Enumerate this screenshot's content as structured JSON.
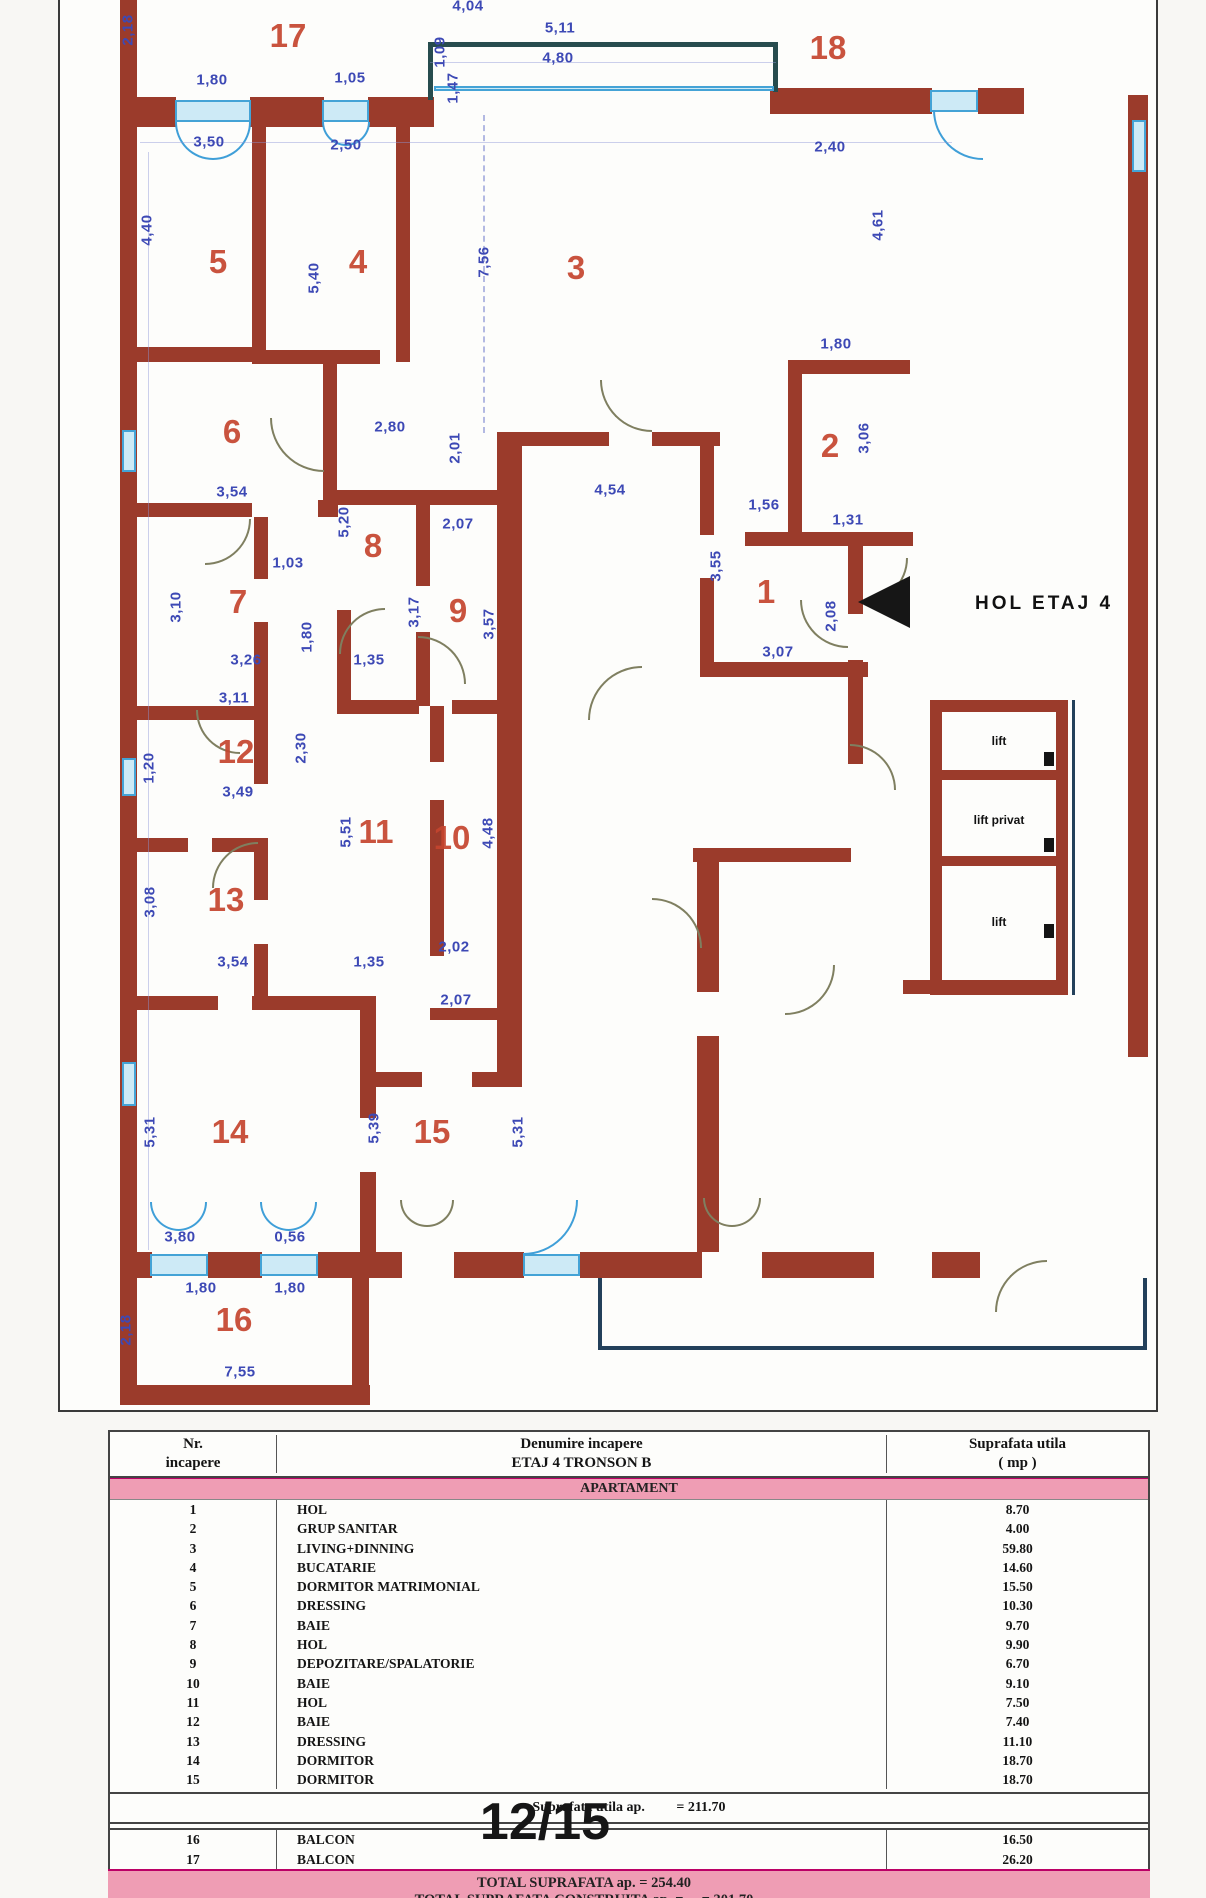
{
  "plan": {
    "hall_label": "HOL ETAJ 4",
    "lift_labels": [
      {
        "t": "lift",
        "x": 999,
        "y": 741
      },
      {
        "t": "lift privat",
        "x": 999,
        "y": 820
      },
      {
        "t": "lift",
        "x": 999,
        "y": 922
      }
    ],
    "rooms": [
      {
        "n": "17",
        "x": 288,
        "y": 36
      },
      {
        "n": "18",
        "x": 828,
        "y": 48
      },
      {
        "n": "5",
        "x": 218,
        "y": 262
      },
      {
        "n": "4",
        "x": 358,
        "y": 262
      },
      {
        "n": "3",
        "x": 576,
        "y": 268
      },
      {
        "n": "6",
        "x": 232,
        "y": 432
      },
      {
        "n": "2",
        "x": 830,
        "y": 446
      },
      {
        "n": "8",
        "x": 373,
        "y": 546
      },
      {
        "n": "7",
        "x": 238,
        "y": 602
      },
      {
        "n": "9",
        "x": 458,
        "y": 611
      },
      {
        "n": "1",
        "x": 766,
        "y": 592
      },
      {
        "n": "12",
        "x": 236,
        "y": 752
      },
      {
        "n": "11",
        "x": 376,
        "y": 832
      },
      {
        "n": "10",
        "x": 452,
        "y": 838
      },
      {
        "n": "13",
        "x": 226,
        "y": 900
      },
      {
        "n": "14",
        "x": 230,
        "y": 1132
      },
      {
        "n": "15",
        "x": 432,
        "y": 1132
      },
      {
        "n": "16",
        "x": 234,
        "y": 1320
      }
    ],
    "dims": [
      {
        "t": "2,18",
        "x": 128,
        "y": 30,
        "v": 1
      },
      {
        "t": "1,80",
        "x": 212,
        "y": 80
      },
      {
        "t": "1,05",
        "x": 350,
        "y": 78
      },
      {
        "t": "1,09",
        "x": 440,
        "y": 52,
        "v": 1
      },
      {
        "t": "1,47",
        "x": 453,
        "y": 88,
        "v": 1
      },
      {
        "t": "5,11",
        "x": 560,
        "y": 28
      },
      {
        "t": "4,80",
        "x": 558,
        "y": 58
      },
      {
        "t": "4,04",
        "x": 468,
        "y": 6
      },
      {
        "t": "2,40",
        "x": 830,
        "y": 147
      },
      {
        "t": "3,50",
        "x": 209,
        "y": 142
      },
      {
        "t": "2,50",
        "x": 346,
        "y": 145
      },
      {
        "t": "4,40",
        "x": 147,
        "y": 230,
        "v": 1
      },
      {
        "t": "5,40",
        "x": 314,
        "y": 278,
        "v": 1
      },
      {
        "t": "7,56",
        "x": 484,
        "y": 262,
        "v": 1
      },
      {
        "t": "4,61",
        "x": 878,
        "y": 225,
        "v": 1
      },
      {
        "t": "1,80",
        "x": 836,
        "y": 344
      },
      {
        "t": "3,06",
        "x": 864,
        "y": 438,
        "v": 1
      },
      {
        "t": "2,80",
        "x": 390,
        "y": 427
      },
      {
        "t": "2,01",
        "x": 455,
        "y": 448,
        "v": 1
      },
      {
        "t": "3,54",
        "x": 232,
        "y": 492
      },
      {
        "t": "4,54",
        "x": 610,
        "y": 490
      },
      {
        "t": "1,56",
        "x": 764,
        "y": 505
      },
      {
        "t": "1,31",
        "x": 848,
        "y": 520
      },
      {
        "t": "5,20",
        "x": 344,
        "y": 522,
        "v": 1
      },
      {
        "t": "2,07",
        "x": 458,
        "y": 524
      },
      {
        "t": "3,17",
        "x": 414,
        "y": 612,
        "v": 1
      },
      {
        "t": "3,57",
        "x": 489,
        "y": 624,
        "v": 1
      },
      {
        "t": "3,55",
        "x": 716,
        "y": 566,
        "v": 1
      },
      {
        "t": "1,03",
        "x": 288,
        "y": 563
      },
      {
        "t": "3,10",
        "x": 176,
        "y": 607,
        "v": 1
      },
      {
        "t": "1,80",
        "x": 307,
        "y": 637,
        "v": 1
      },
      {
        "t": "2,08",
        "x": 831,
        "y": 616,
        "v": 1
      },
      {
        "t": "3,07",
        "x": 778,
        "y": 652
      },
      {
        "t": "3,26",
        "x": 246,
        "y": 660
      },
      {
        "t": "1,35",
        "x": 369,
        "y": 660
      },
      {
        "t": "3,11",
        "x": 234,
        "y": 698
      },
      {
        "t": "2,30",
        "x": 301,
        "y": 748,
        "v": 1
      },
      {
        "t": "1,20",
        "x": 149,
        "y": 768,
        "v": 1
      },
      {
        "t": "3,49",
        "x": 238,
        "y": 792
      },
      {
        "t": "5,51",
        "x": 346,
        "y": 832,
        "v": 1
      },
      {
        "t": "4,48",
        "x": 488,
        "y": 833,
        "v": 1
      },
      {
        "t": "3,08",
        "x": 150,
        "y": 902,
        "v": 1
      },
      {
        "t": "3,54",
        "x": 233,
        "y": 962
      },
      {
        "t": "1,35",
        "x": 369,
        "y": 962
      },
      {
        "t": "2,02",
        "x": 454,
        "y": 947
      },
      {
        "t": "2,07",
        "x": 456,
        "y": 1000
      },
      {
        "t": "5,31",
        "x": 150,
        "y": 1132,
        "v": 1
      },
      {
        "t": "5,39",
        "x": 374,
        "y": 1128,
        "v": 1
      },
      {
        "t": "5,31",
        "x": 518,
        "y": 1132,
        "v": 1
      },
      {
        "t": "3,80",
        "x": 180,
        "y": 1237
      },
      {
        "t": "0,56",
        "x": 290,
        "y": 1237
      },
      {
        "t": "1,80",
        "x": 201,
        "y": 1288
      },
      {
        "t": "1,80",
        "x": 290,
        "y": 1288
      },
      {
        "t": "2,18",
        "x": 126,
        "y": 1330,
        "v": 1
      },
      {
        "t": "7,55",
        "x": 240,
        "y": 1372
      }
    ]
  },
  "table": {
    "header": {
      "nr": "Nr.\nincapere",
      "name": "Denumire incapere\nETAJ 4 TRONSON B",
      "area": "Suprafata utila\n( mp )"
    },
    "section_label": "APARTAMENT",
    "rows": [
      {
        "nr": "1",
        "name": "HOL",
        "area": "8.70"
      },
      {
        "nr": "2",
        "name": "GRUP SANITAR",
        "area": "4.00"
      },
      {
        "nr": "3",
        "name": "LIVING+DINNING",
        "area": "59.80"
      },
      {
        "nr": "4",
        "name": "BUCATARIE",
        "area": "14.60"
      },
      {
        "nr": "5",
        "name": "DORMITOR MATRIMONIAL",
        "area": "15.50"
      },
      {
        "nr": "6",
        "name": "DRESSING",
        "area": "10.30"
      },
      {
        "nr": "7",
        "name": "BAIE",
        "area": "9.70"
      },
      {
        "nr": "8",
        "name": "HOL",
        "area": "9.90"
      },
      {
        "nr": "9",
        "name": "DEPOZITARE/SPALATORIE",
        "area": "6.70"
      },
      {
        "nr": "10",
        "name": "BAIE",
        "area": "9.10"
      },
      {
        "nr": "11",
        "name": "HOL",
        "area": "7.50"
      },
      {
        "nr": "12",
        "name": "BAIE",
        "area": "7.40"
      },
      {
        "nr": "13",
        "name": "DRESSING",
        "area": "11.10"
      },
      {
        "nr": "14",
        "name": "DORMITOR",
        "area": "18.70"
      },
      {
        "nr": "15",
        "name": "DORMITOR",
        "area": "18.70"
      }
    ],
    "subtotal_label": "Suprafata utila ap.",
    "subtotal_value": "= 211.70",
    "balcony_rows": [
      {
        "nr": "16",
        "name": "BALCON",
        "area": "16.50"
      },
      {
        "nr": "17",
        "name": "BALCON",
        "area": "26.20"
      }
    ],
    "total_line1": "TOTAL SUPRAFATA ap.      = 254.40",
    "total_line2": "TOTAL SUPRAFATA CONSTRUITA ap. = ... = 301.70"
  },
  "page_indicator": "12/15"
}
